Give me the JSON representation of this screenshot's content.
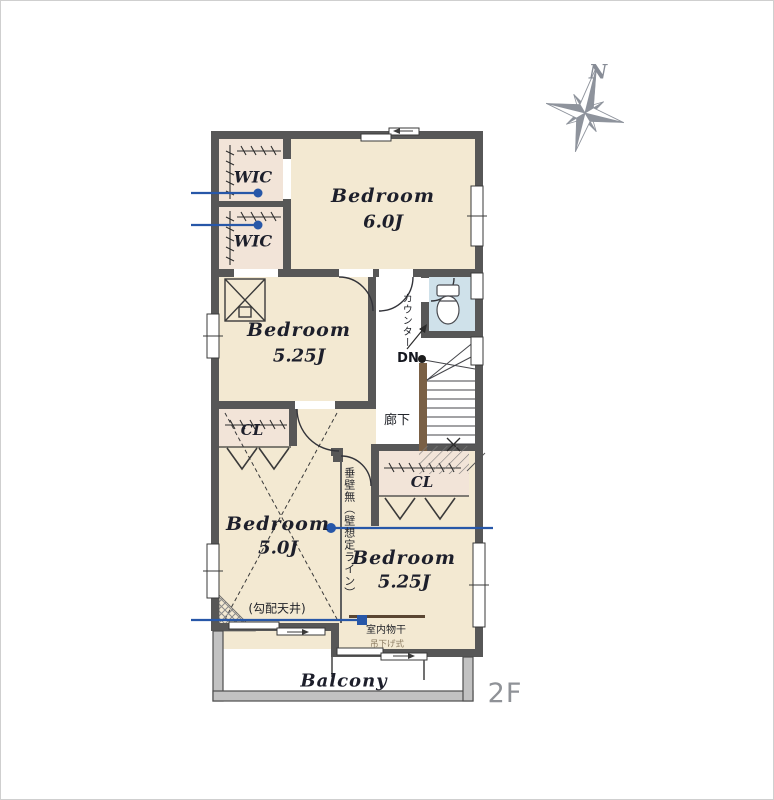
{
  "floor_indicator": "2F",
  "compass": {
    "north_label": "N"
  },
  "rooms": {
    "bedroom6": {
      "name": "Bedroom",
      "size": "6.0J"
    },
    "bedroom525mid": {
      "name": "Bedroom",
      "size": "5.25J"
    },
    "bedroom50": {
      "name": "Bedroom",
      "size": "5.0J",
      "ceiling_note": "(勾配天井)"
    },
    "bedroom525btm": {
      "name": "Bedroom",
      "size": "5.25J"
    },
    "balcony": {
      "label": "Balcony"
    },
    "hallway": {
      "label": "廊下"
    }
  },
  "labels": {
    "wic1": "WIC",
    "wic2": "WIC",
    "cl_left": "CL",
    "cl_right": "CL",
    "counter": "カウンター",
    "stairs_down": "DN",
    "no_hanging_wall": "垂壁無（壁想定ライン）",
    "indoor_drying": "室内物干",
    "drying_type": "吊下げ式"
  },
  "colors": {
    "wall": "#575757",
    "floor_beige": "#f3e9d2",
    "closet_floor": "#f2e4d8",
    "toilet_floor": "#cfe1ea",
    "annotation_blue": "#2757a8",
    "compass_gray": "#8e939c",
    "stair_rail_brown": "#7a6045"
  }
}
